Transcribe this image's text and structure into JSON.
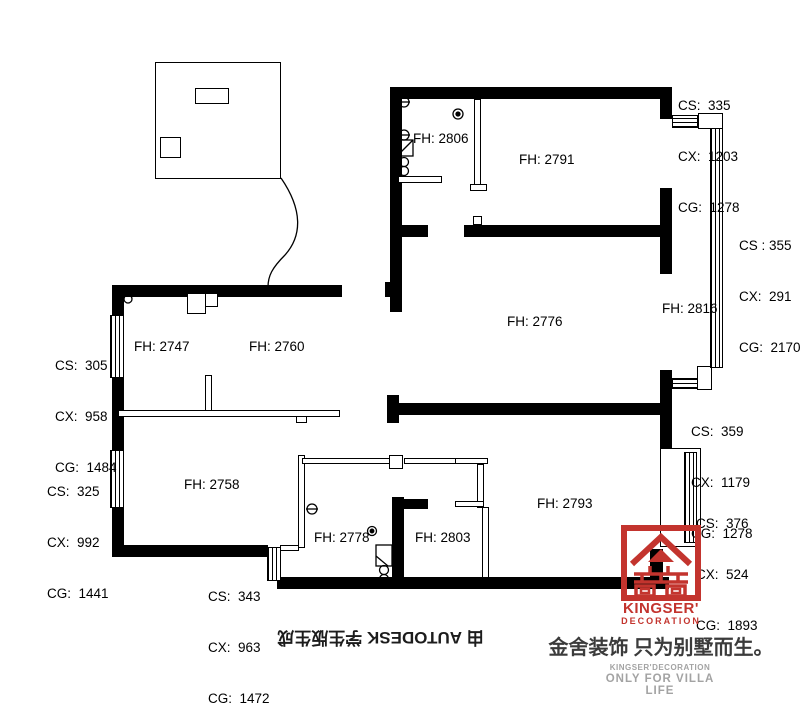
{
  "colors": {
    "wall": "#000000",
    "brand_red": "#c3342e",
    "muted_gray": "#a3a3a3",
    "ink": "#1c1c1c"
  },
  "room_labels": {
    "fh2806": "FH: 2806",
    "fh2791": "FH: 2791",
    "fh2776": "FH: 2776",
    "fh2816": "FH: 2816",
    "fh2747": "FH: 2747",
    "fh2760": "FH: 2760",
    "fh2758": "FH: 2758",
    "fh2778": "FH: 2778",
    "fh2803": "FH: 2803",
    "fh2793": "FH: 2793"
  },
  "dimensions": {
    "top_right": [
      "CS:  335",
      "CX:  1203",
      "CG:  1278"
    ],
    "right_upper": [
      "CS : 355",
      "CX:  291",
      "CG:  2170"
    ],
    "right_middle": [
      "CS:  359",
      "CX:  1179",
      "CG:  1278"
    ],
    "right_lower": [
      "CS:  376",
      "CX:  524",
      "CG:  1893"
    ],
    "left_upper": [
      "CS:  305",
      "CX:  958",
      "CG:  1484"
    ],
    "left_lower": [
      "CS:  325",
      "CX:  992",
      "CG:  1441"
    ],
    "bottom": [
      "CS:  343",
      "CX:  963",
      "CG:  1472"
    ]
  },
  "stamp": {
    "text": "由 AUTODESK 学生版生成"
  },
  "brand": {
    "logo_name": "KINGSER'",
    "logo_sub": "DECORATION",
    "tagline_cn": "金舍装饰 只为别墅而生。",
    "footer_line1": "KINGSER'DECORATION",
    "footer_line2": "ONLY FOR VILLA LIFE"
  }
}
